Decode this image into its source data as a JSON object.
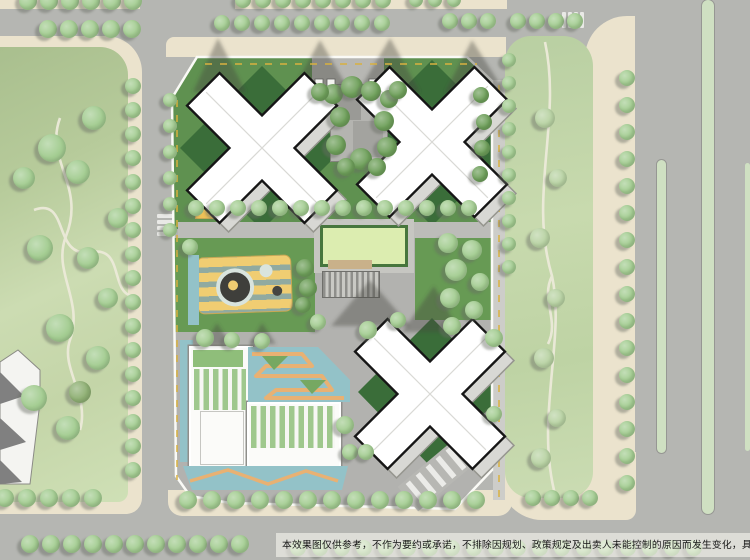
{
  "title": "residential development master plan aerial rendering",
  "disclaimer": {
    "text": "本效果图仅供参考，不作为要约或承诺，不排除因规划、政策规定及出卖人未能控制的原因而发生变化，具"
  },
  "colors": {
    "road": "#b5b6b2",
    "sidewalk": "#ebe3cd",
    "park_dark": "#a9bf8e",
    "park_mid": "#bccf9f",
    "park_light": "#cfdfb5",
    "tree": "#a4cd92",
    "tree_dark": "#6fa05b",
    "tree_pale": "#b9d3a4",
    "tree_shadow": "rgba(104,108,100,0.45)",
    "paving": "#b2b2af",
    "paving_light": "#c2c2be",
    "site_green": "#5f9150",
    "site_green_dark": "#3a6d39",
    "lawn": "#dcedb0",
    "hedge": "#47763d",
    "pg_yellow": "#f0cd72",
    "pg_stripe": "#8fb4b8",
    "water": "#93c2c8",
    "orange": "#e8b173",
    "roof_stripe": "#9fc88d",
    "building_white": "#fbfbf9",
    "outline": "#161616",
    "podium": "#d8d8d4",
    "median": "#cfe0c2",
    "shadow": "rgba(70,70,66,0.40)",
    "band": "rgba(248,246,240,0.60)",
    "dash_yellow": "#d9b13f",
    "text": "#161616"
  }
}
